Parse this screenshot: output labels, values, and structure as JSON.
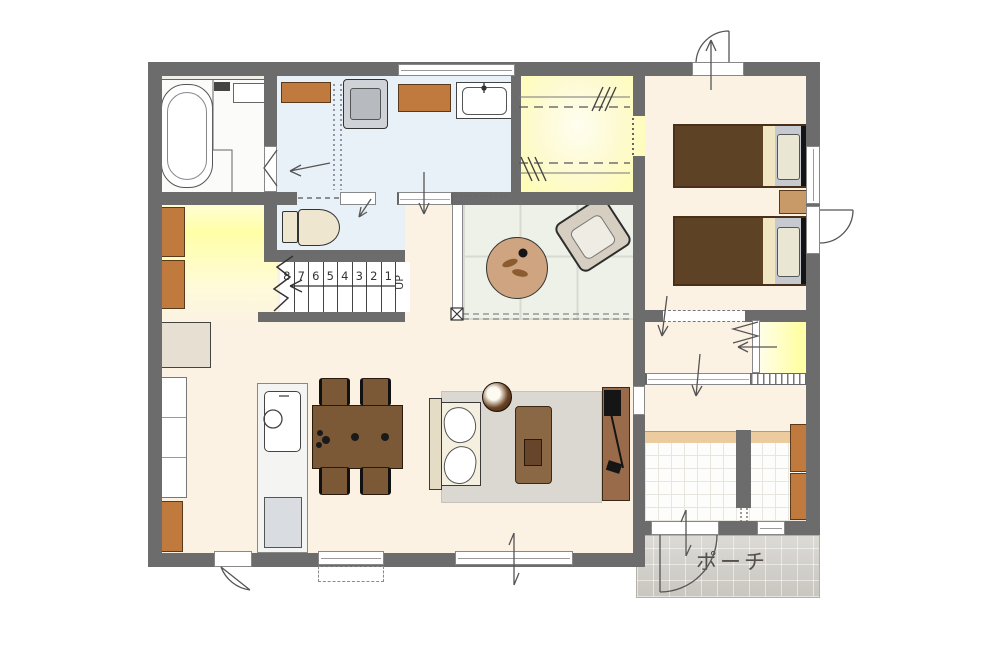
{
  "labels": {
    "porch": "ポーチ",
    "up": "UP"
  },
  "stairs": {
    "numbers": [
      "8",
      "7",
      "6",
      "5",
      "4",
      "3",
      "2",
      "1"
    ]
  },
  "colors": {
    "wall": "#6c6c6c",
    "floor_cream": "#fbf2e3",
    "floor_blue": "#e8f1f8",
    "floor_yellow": "#ffffa6",
    "tatami": "#eef1e7",
    "tatami_line": "#d8dcd0",
    "brown": "#7b5836",
    "brown_dark": "#5d4226",
    "orange": "#c07a3e",
    "rug": "#dbd8d2",
    "porch": "#d2cfc9",
    "outline": "#3c3c3c"
  }
}
